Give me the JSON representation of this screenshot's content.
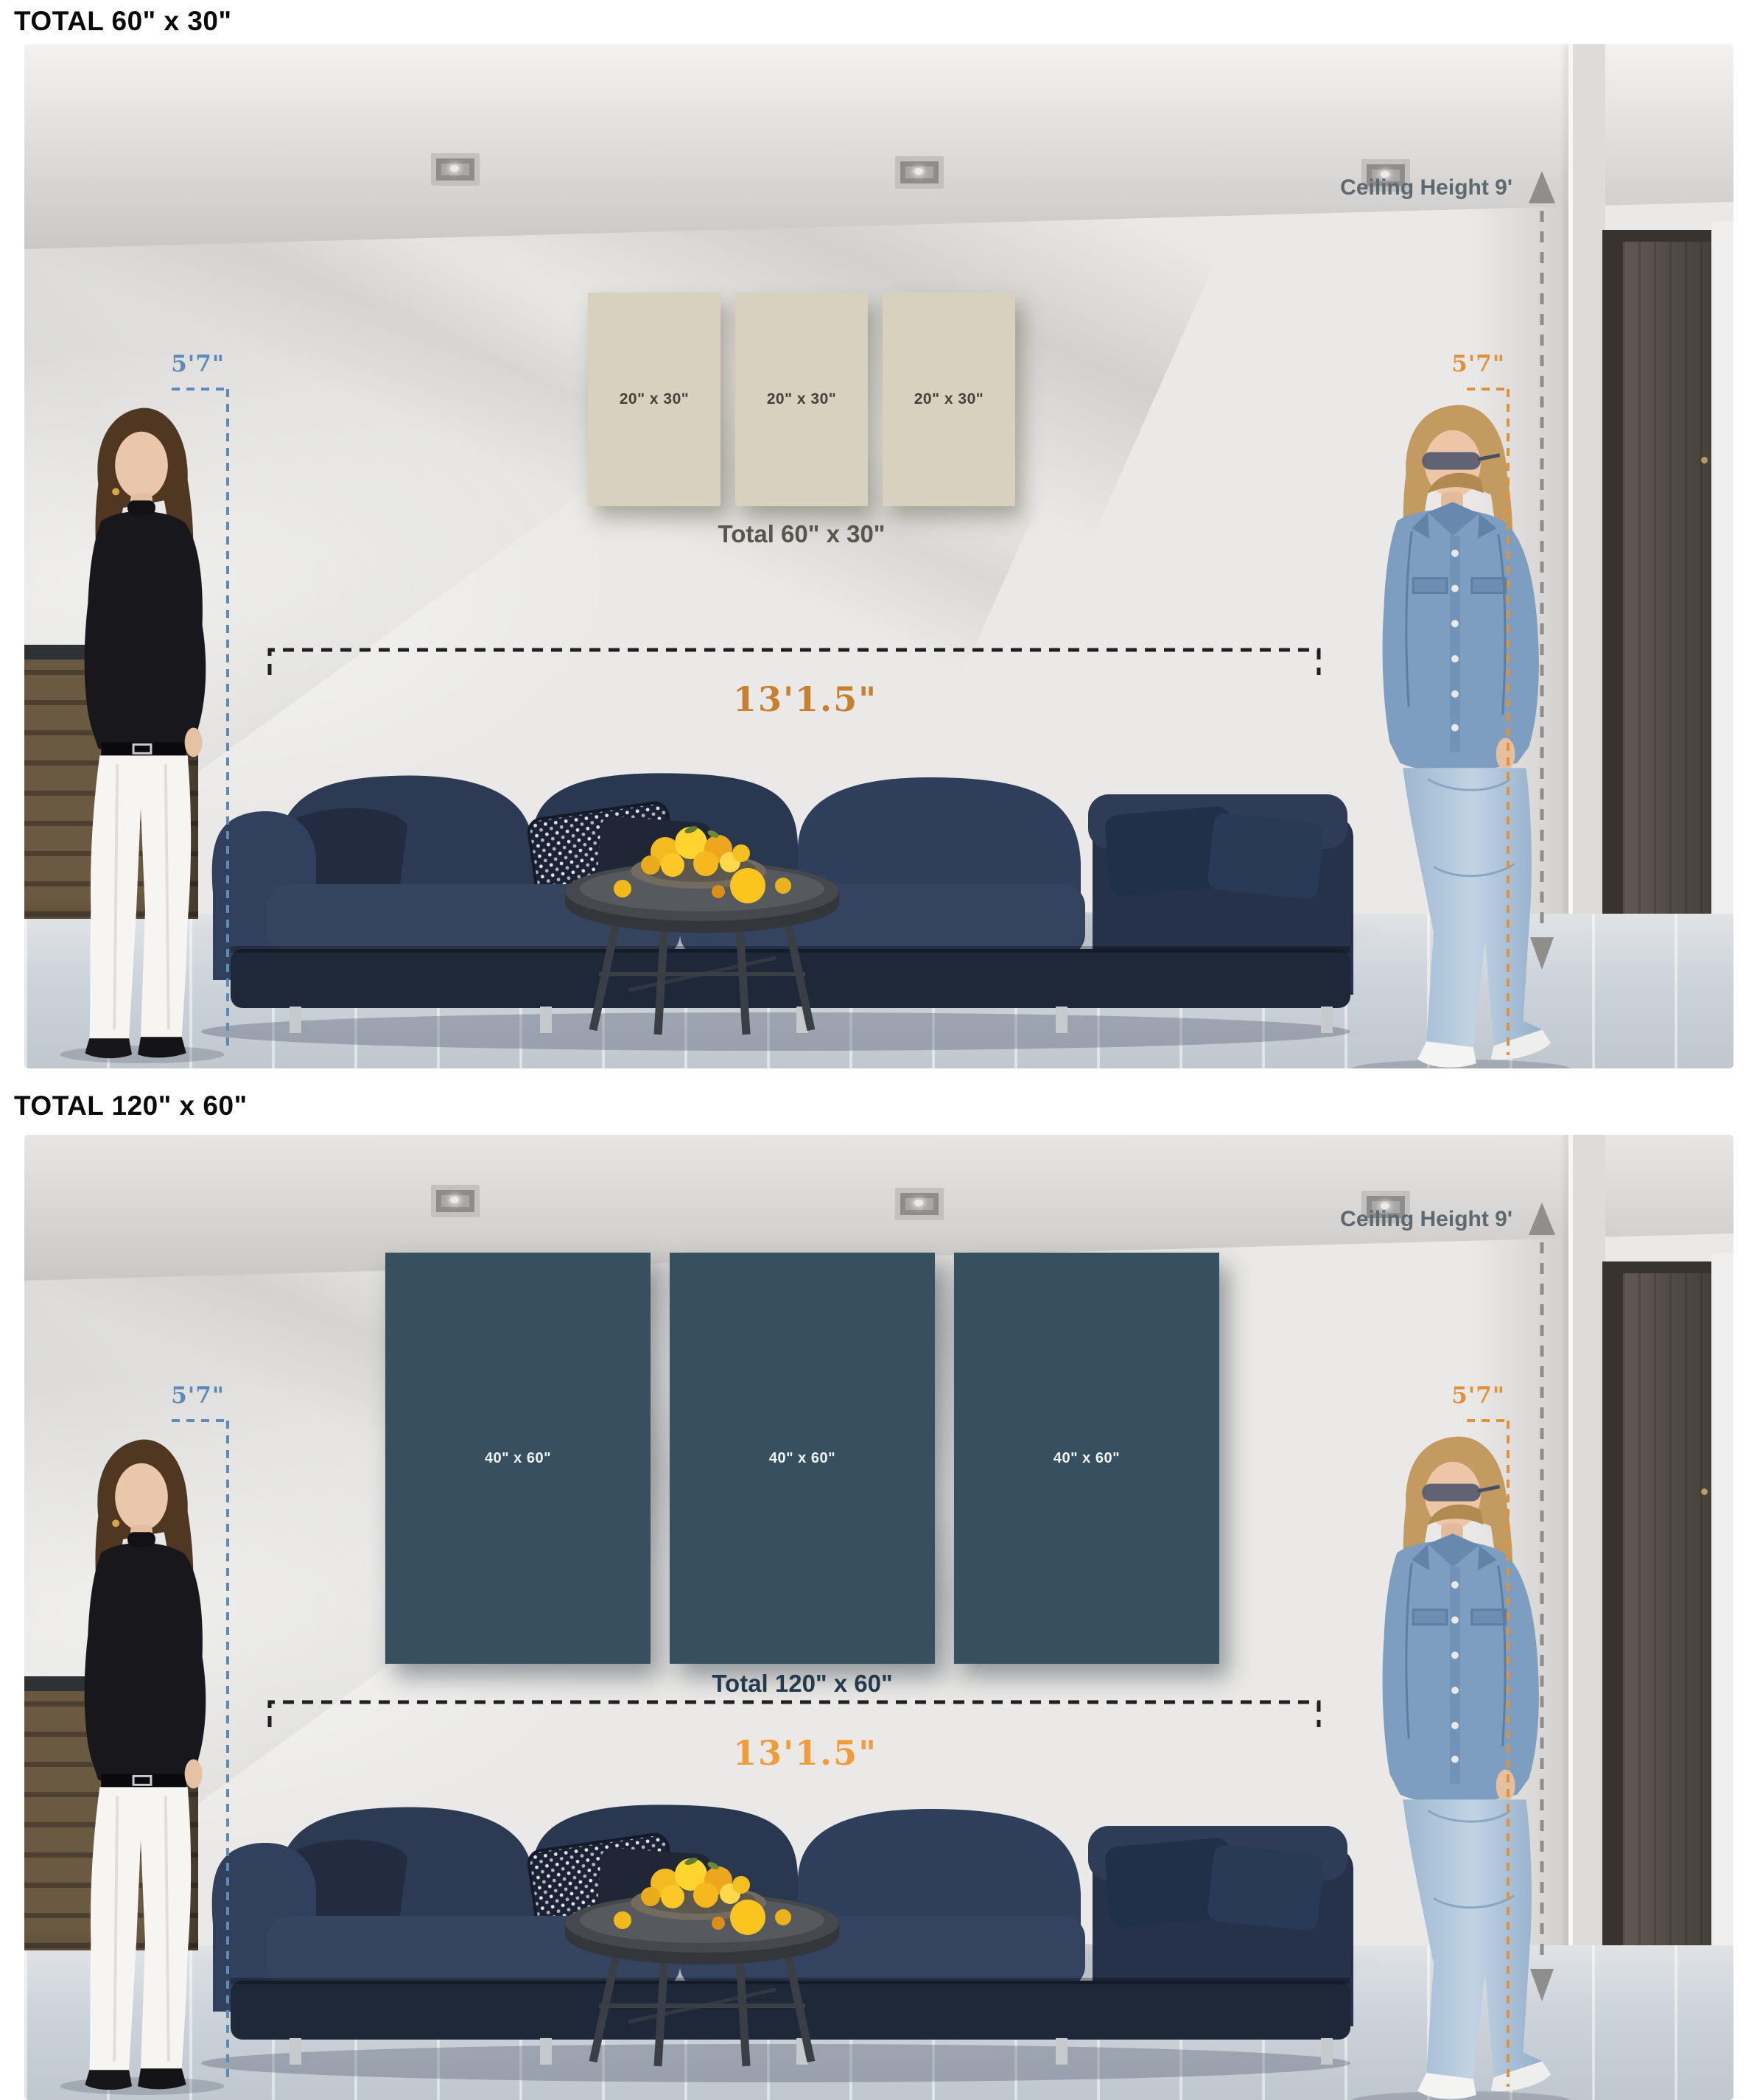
{
  "sections": [
    {
      "heading": "TOTAL 60\" x 30\"",
      "ceiling_label": "Ceiling Height 9'",
      "left_person_height": "5'7\"",
      "right_person_height": "5'7\"",
      "sofa_width_label": "13'1.5\"",
      "sofa_width_color": "#c6802e",
      "panels": [
        {
          "label": "20\" x 30\""
        },
        {
          "label": "20\" x 30\""
        },
        {
          "label": "20\" x 30\""
        }
      ],
      "panel_color": "#d9d1bf",
      "panel_label_color": "#46413a",
      "total_label": "Total 60\" x 30\"",
      "total_label_color": "#59544c"
    },
    {
      "heading": "TOTAL 120\" x 60\"",
      "ceiling_label": "Ceiling Height 9'",
      "left_person_height": "5'7\"",
      "right_person_height": "5'7\"",
      "sofa_width_label": "13'1.5\"",
      "sofa_width_color": "#f19c3b",
      "panels": [
        {
          "label": "40\" x 60\""
        },
        {
          "label": "40\" x 60\""
        },
        {
          "label": "40\" x 60\""
        }
      ],
      "panel_color": "#37505f",
      "panel_label_color": "#f2f4f5",
      "total_label": "Total 120\" x 60\"",
      "total_label_color": "#233a4d"
    }
  ],
  "annotations": {
    "ceiling_text_color": "#5d686f",
    "ceiling_line_color": "#8f8e8c",
    "left_marker_color": "#5e8ab8",
    "right_marker_color": "#e0913c",
    "sofa_line_color": "#1f1f22"
  }
}
